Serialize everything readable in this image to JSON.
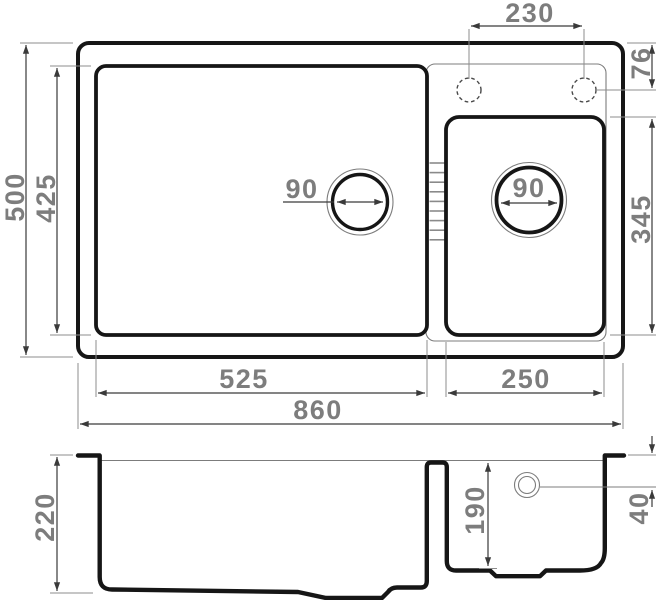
{
  "meta": {
    "type": "technical-drawing",
    "subject": "double-bowl kitchen sink dimensions",
    "units": "mm",
    "views": [
      "top view",
      "section view"
    ]
  },
  "colors": {
    "outline": "#161616",
    "dim_line": "#3a3a3a",
    "ext_line": "#8c8c8c",
    "thin_line": "#7c7c7c",
    "rib": "#8a8a8a",
    "dim_text": "#7d7d7d"
  },
  "top_view": {
    "overall": {
      "width": "860",
      "depth": "500"
    },
    "left_bowl": {
      "width": "525",
      "depth": "425",
      "drain_diameter": "90"
    },
    "right_bowl": {
      "width": "250",
      "depth": "345",
      "drain_diameter": "90"
    },
    "faucet_holes": {
      "spacing": "230",
      "offset_from_edge": "76"
    }
  },
  "section_view": {
    "left_bowl_depth": "220",
    "right_bowl_depth": "190",
    "drain_offset_from_rim": "40"
  }
}
